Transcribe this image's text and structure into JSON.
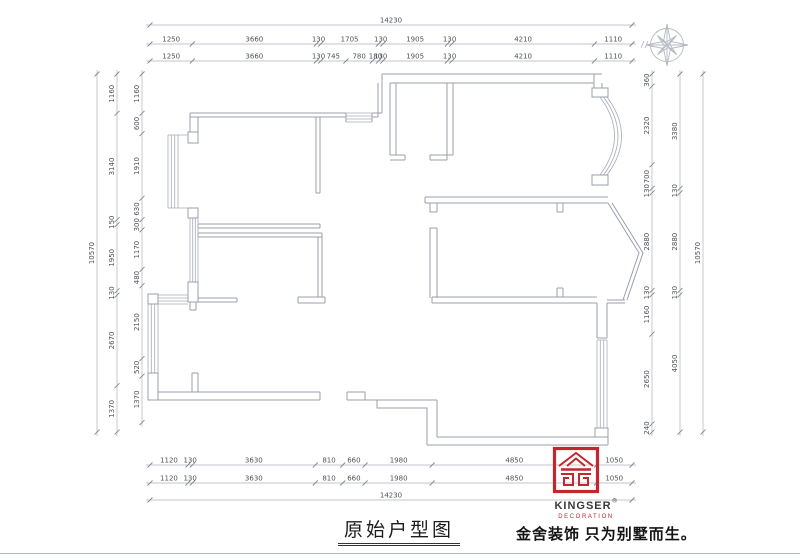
{
  "title": {
    "text": "原始户型图"
  },
  "slogan": "金舍装饰 只为别墅而生。",
  "logo": {
    "name": "KINGSER",
    "reg": "®",
    "sub": "DECORATION",
    "accent_color": "#c1272d"
  },
  "colors": {
    "wall": "#9aa0aa",
    "dim_line": "#adb2ba",
    "dim_text": "#4e5257",
    "brand_red": "#c1272d"
  },
  "units": "mm",
  "dims": {
    "top_overall": [
      14230
    ],
    "top_row1": [
      1250,
      3660,
      130,
      1705,
      130,
      1905,
      130,
      4210,
      1110
    ],
    "top_row2": [
      1250,
      3660,
      130,
      745,
      780,
      180,
      130,
      1905,
      130,
      4210,
      1110
    ],
    "bottom_row1": [
      1120,
      130,
      3630,
      810,
      660,
      1980,
      4850,
      1050
    ],
    "bottom_row2": [
      1120,
      130,
      3630,
      810,
      660,
      1980,
      4850,
      1050
    ],
    "bottom_overall": [
      14230
    ],
    "left_overall": [
      10570
    ],
    "left_outer": [
      1160,
      3140,
      150,
      1950,
      130,
      2670,
      1370
    ],
    "left_inner": [
      1160,
      600,
      1910,
      630,
      300,
      1170,
      480,
      2150,
      520,
      1370
    ],
    "right_inner": [
      360,
      2320,
      700,
      130,
      2880,
      130,
      1160,
      2650,
      240
    ],
    "right_outer": [
      3380,
      130,
      2880,
      130,
      4050
    ],
    "right_overall": [
      10570
    ]
  }
}
